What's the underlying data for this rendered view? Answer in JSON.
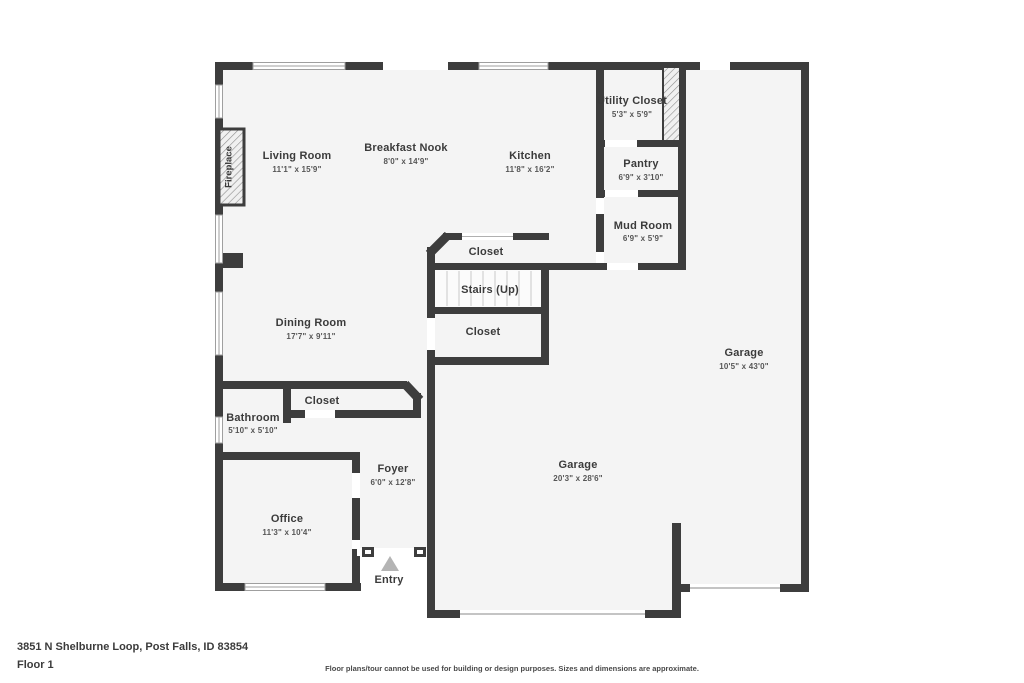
{
  "plan": {
    "colors": {
      "wall": "#3d3d3d",
      "floor": "#f4f4f4",
      "window_frame": "#9f9f9f",
      "stair_tread": "#c9c9c9",
      "entry_arrow": "#b4b4b4"
    },
    "rooms": {
      "living_room": {
        "name": "Living Room",
        "dims": "11'1\" x 15'9\""
      },
      "breakfast_nook": {
        "name": "Breakfast Nook",
        "dims": "8'0\" x 14'9\""
      },
      "kitchen": {
        "name": "Kitchen",
        "dims": "11'8\" x 16'2\""
      },
      "utility_closet": {
        "name": "Utility Closet",
        "dims": "5'3\" x 5'9\""
      },
      "pantry": {
        "name": "Pantry",
        "dims": "6'9\" x 3'10\""
      },
      "mud_room": {
        "name": "Mud Room",
        "dims": "6'9\" x 5'9\""
      },
      "closet_upper": {
        "name": "Closet"
      },
      "stairs": {
        "name": "Stairs (Up)"
      },
      "closet_lower": {
        "name": "Closet"
      },
      "dining_room": {
        "name": "Dining Room",
        "dims": "17'7\" x 9'11\""
      },
      "garage_side": {
        "name": "Garage",
        "dims": "10'5\" x 43'0\""
      },
      "bathroom": {
        "name": "Bathroom",
        "dims": "5'10\" x 5'10\""
      },
      "closet_bath": {
        "name": "Closet"
      },
      "foyer": {
        "name": "Foyer",
        "dims": "6'0\" x 12'8\""
      },
      "office": {
        "name": "Office",
        "dims": "11'3\" x 10'4\""
      },
      "garage_main": {
        "name": "Garage",
        "dims": "20'3\" x 28'6\""
      }
    },
    "markers": {
      "entry": "Entry",
      "fireplace": "Fireplace"
    }
  },
  "footer": {
    "address": "3851 N Shelburne Loop, Post Falls, ID 83854",
    "floor": "Floor 1",
    "disclaimer": "Floor plans/tour cannot be used for building or design purposes. Sizes and dimensions are approximate."
  }
}
